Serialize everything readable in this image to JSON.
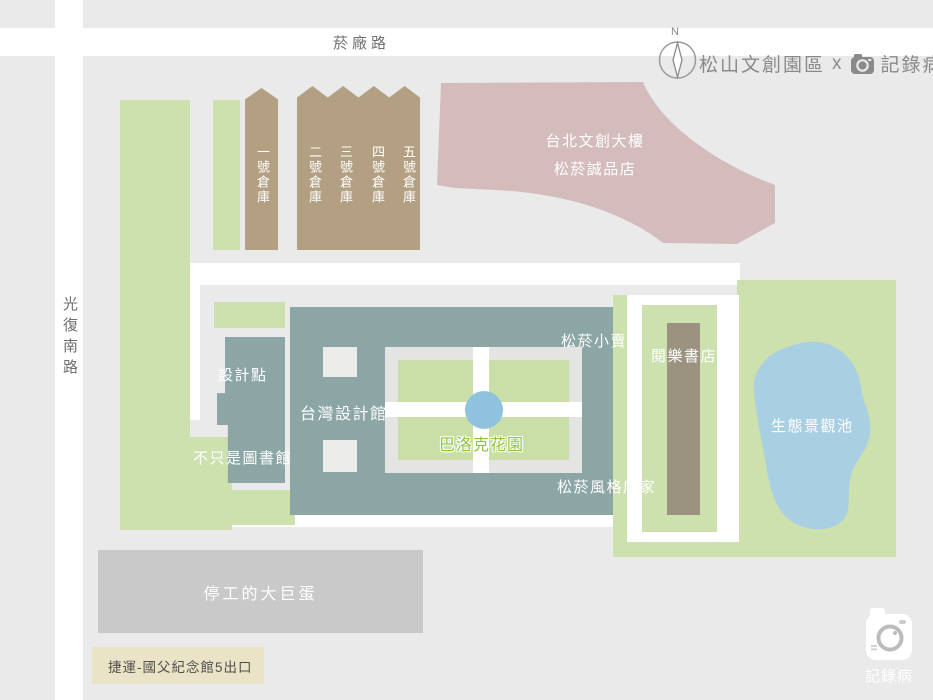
{
  "header": {
    "compass_label": "N",
    "title_park": "松山文創園區",
    "title_separator": "x",
    "title_brand": "記錄病"
  },
  "roads": {
    "top_road": "菸廠路",
    "left_road": "光復南路"
  },
  "warehouses": [
    "一號倉庫",
    "二號倉庫",
    "三號倉庫",
    "四號倉庫",
    "五號倉庫"
  ],
  "buildings": {
    "taipei_new_horizon_line1": "台北文創大樓",
    "taipei_new_horizon_line2": "松菸誠品店",
    "design_point": "設計點",
    "taiwan_design_museum": "台灣設計館",
    "not_just_library": "不只是圖書館",
    "baroque_garden": "巴洛克花園",
    "songyan_shop": "松菸小賣所",
    "yueyue_bookstore": "閱樂書店",
    "songyan_style_stores": "松菸風格店家",
    "eco_pond": "生態景觀池",
    "dome": "停工的大巨蛋"
  },
  "footer": {
    "mrt_exit": "捷運-國父紀念館5出口",
    "logo_brand": "記錄病"
  },
  "colors": {
    "background": "#eaeaea",
    "road_white": "#ffffff",
    "green": "#cde1ae",
    "warehouse_tan": "#b3a083",
    "pink_building": "#d4bcbc",
    "teal_building": "#8ba6a4",
    "brown_building": "#9b9280",
    "pond_blue": "#a9cfe3",
    "fountain_blue": "#8fc3dd",
    "dome_gray": "#c9c9c9",
    "mrt_beige": "#ebe3c5",
    "title_gray": "#8a8a8a",
    "garden_label_green": "#8cc63e"
  }
}
